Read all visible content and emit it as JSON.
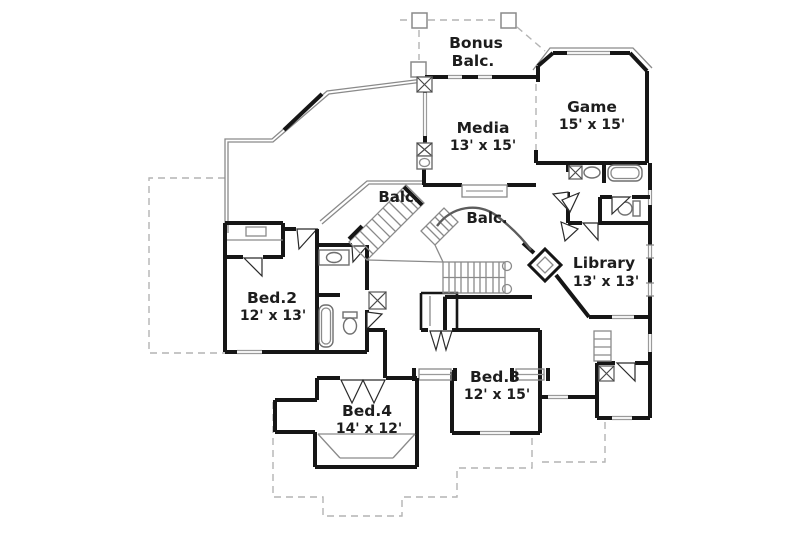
{
  "rooms": {
    "bonus_balcony": {
      "name": "Bonus",
      "name_line2": "Balc."
    },
    "media": {
      "name": "Media",
      "dims": "13' x 15'"
    },
    "game": {
      "name": "Game",
      "dims": "15' x 15'"
    },
    "balcony_left": {
      "name": "Balc."
    },
    "balcony_right": {
      "name": "Balc."
    },
    "library": {
      "name": "Library",
      "dims": "13' x 13'"
    },
    "bed2": {
      "name": "Bed.2",
      "dims": "12' x 13'"
    },
    "bed3": {
      "name": "Bed.3",
      "dims": "12' x 15'"
    },
    "bed4": {
      "name": "Bed.4",
      "dims": "14' x 12'"
    }
  },
  "colors": {
    "wall_ink": "#161616",
    "thin_line": "#8a8a8a",
    "dashed_line": "#b4b4b4",
    "text_ink": "#1d1d1d",
    "background": "#ffffff"
  }
}
